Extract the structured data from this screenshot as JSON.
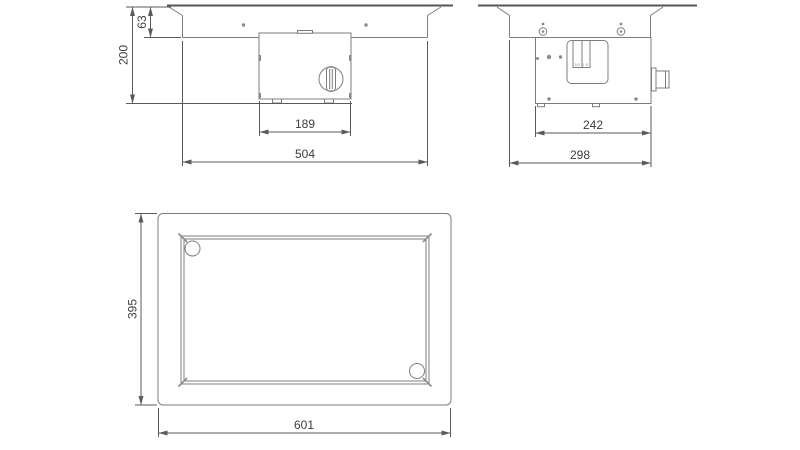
{
  "document": {
    "type": "technical-dimension-drawing",
    "units_shown": false
  },
  "colors": {
    "background": "#ffffff",
    "outline": "#7d7d7d",
    "heavy_outline": "#565656",
    "dimension_line": "#5a5a5a",
    "dimension_text": "#3d3d3d"
  },
  "views": {
    "front": {
      "name": "front-elevation",
      "dims": {
        "flange_height": "63",
        "total_height": "200",
        "control_box_width": "189",
        "overall_width": "504"
      }
    },
    "side": {
      "name": "side-elevation",
      "dims": {
        "mounting_width": "242",
        "overall_depth": "298"
      },
      "switch_plate_marks": "10 0 0"
    },
    "plan": {
      "name": "plan-view",
      "dims": {
        "overall_depth": "395",
        "overall_width": "601"
      }
    }
  }
}
